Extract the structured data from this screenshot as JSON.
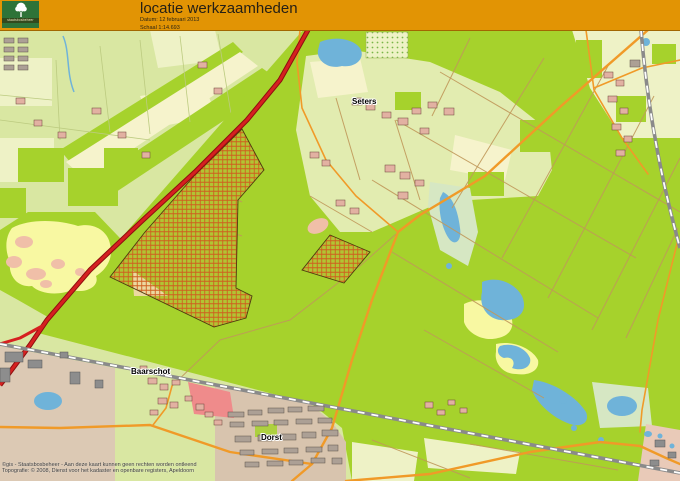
{
  "window": {
    "width": 680,
    "height": 481
  },
  "header": {
    "title": "locatie werkzaamheden",
    "date": "Datum: 12 februari 2013",
    "scale": "Schaal 1:14.693",
    "logo": {
      "text": "staatsbosbeheer"
    }
  },
  "map": {
    "place_labels": [
      {
        "id": "seters",
        "text": "Seters"
      },
      {
        "id": "baarschot",
        "text": "Baarschot"
      },
      {
        "id": "dorst",
        "text": "Dorst"
      }
    ],
    "credits_line1": "©gis - Staatsbosbeheer - Aan deze kaart kunnen geen rechten worden ontleend",
    "credits_line2": "Topografie: © 2008, Dienst voor het kadaster en openbare registers, Apeldoorn"
  },
  "colors": {
    "header_bg": "#e29404",
    "logo_green": "#2e7338",
    "forest": "#a6d22c",
    "farmland": "#d9e7a2",
    "field_pale": "#eef2c6",
    "heath": "#f8f8a2",
    "sand_pink": "#f0bfa8",
    "water": "#6fb3d9",
    "road_orange": "#f09a28",
    "road_red": "#d62020",
    "rail_grey": "#8a8a8a",
    "hatch_line": "#cf5f1f",
    "urban_tan": "#dcc9b4",
    "building_pink": "#e2b1a2"
  }
}
